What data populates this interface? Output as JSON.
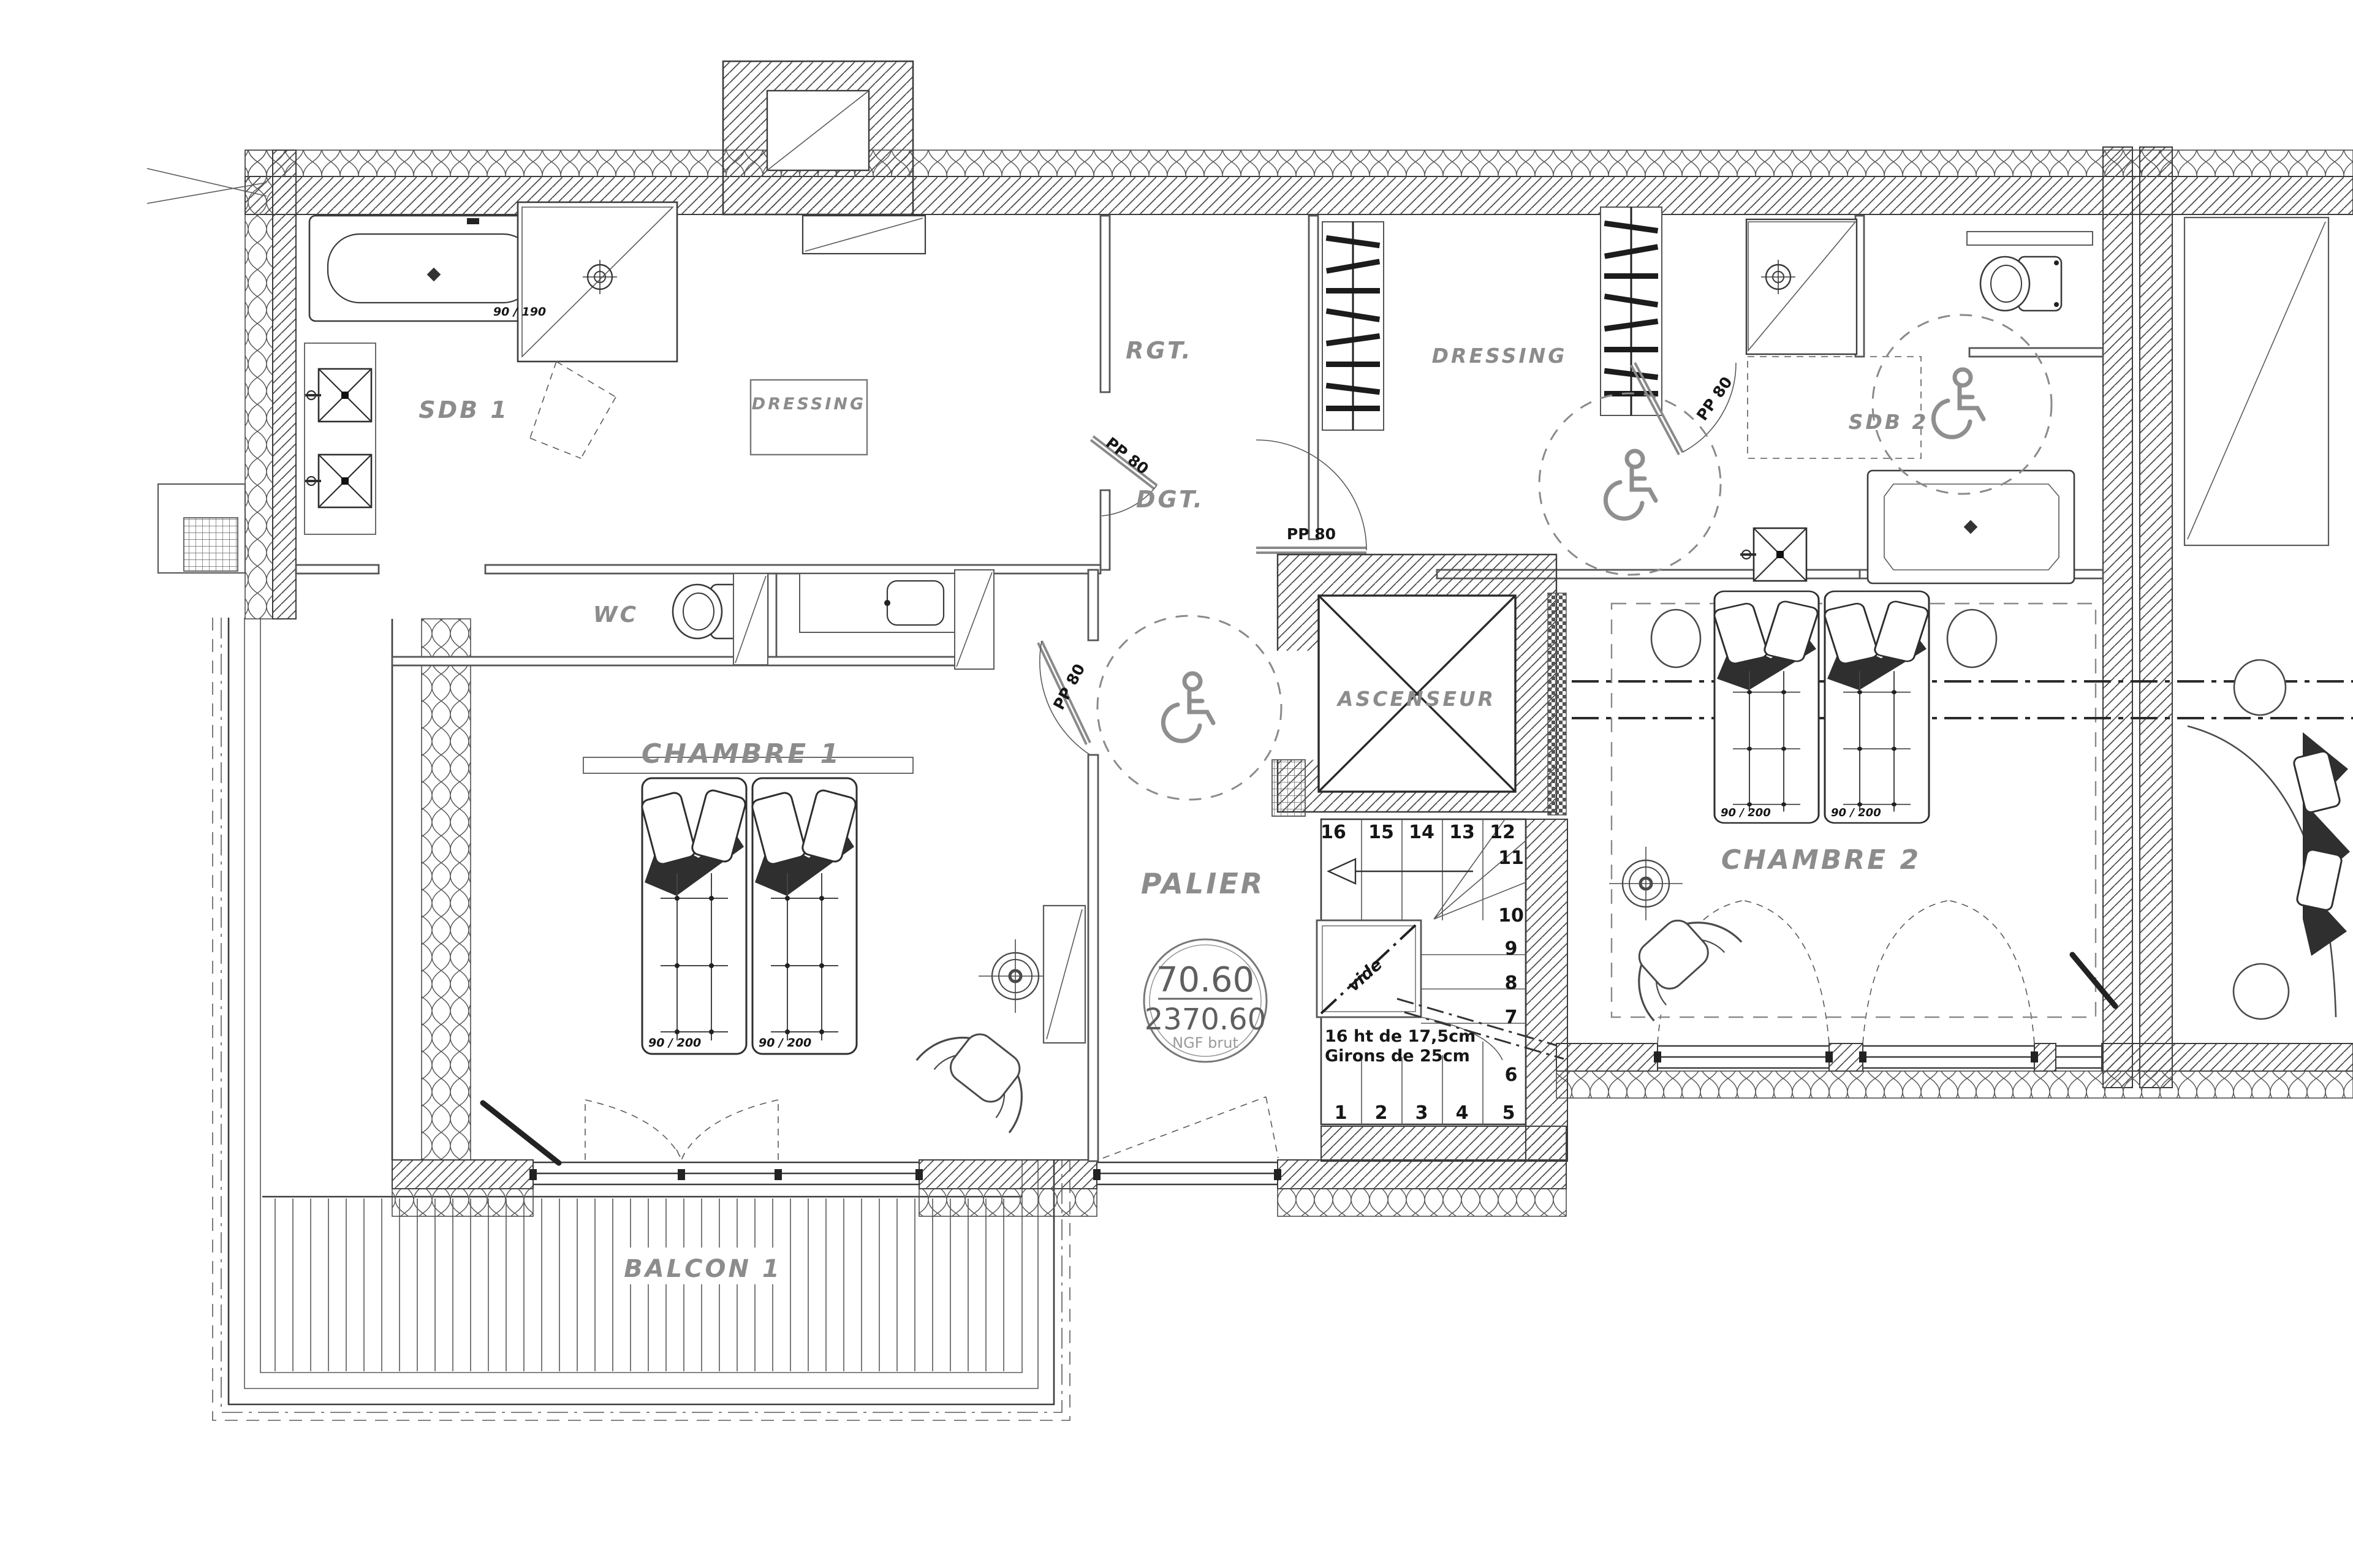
{
  "drawing": {
    "rooms": {
      "sdb1": "SDB 1",
      "dressing1": "DRESSING",
      "wc": "WC",
      "chambre1": "CHAMBRE 1",
      "rgt": "RGT.",
      "dgt": "DGT.",
      "dressing2": "DRESSING",
      "sdb2": "SDB 2",
      "ascenseur": "ASCENSEUR",
      "palier": "PALIER",
      "chambre2": "CHAMBRE 2",
      "balcon1": "BALCON 1"
    },
    "level_marker": {
      "upper": "70.60",
      "lower": "2370.60",
      "caption": "NGF brut"
    },
    "doors": {
      "pp80": "PP 80"
    },
    "furniture": {
      "single_bed": "90 / 200",
      "bathtub": "90 / 190"
    },
    "stairs": {
      "note_line1": "16 ht de 17,5cm",
      "note_line2": "Girons de 25cm",
      "void_label": "vide",
      "numbers_top": [
        "16",
        "15",
        "14",
        "13",
        "12"
      ],
      "numbers_right": [
        "11",
        "10",
        "9",
        "8",
        "7",
        "6"
      ],
      "numbers_bottom": [
        "1",
        "2",
        "3",
        "4",
        "5"
      ]
    },
    "colors": {
      "ink": "#3c3c3c",
      "label_gray": "#8c8c8c",
      "paper": "#ffffff",
      "dark_fill": "#2f2f2f"
    }
  }
}
